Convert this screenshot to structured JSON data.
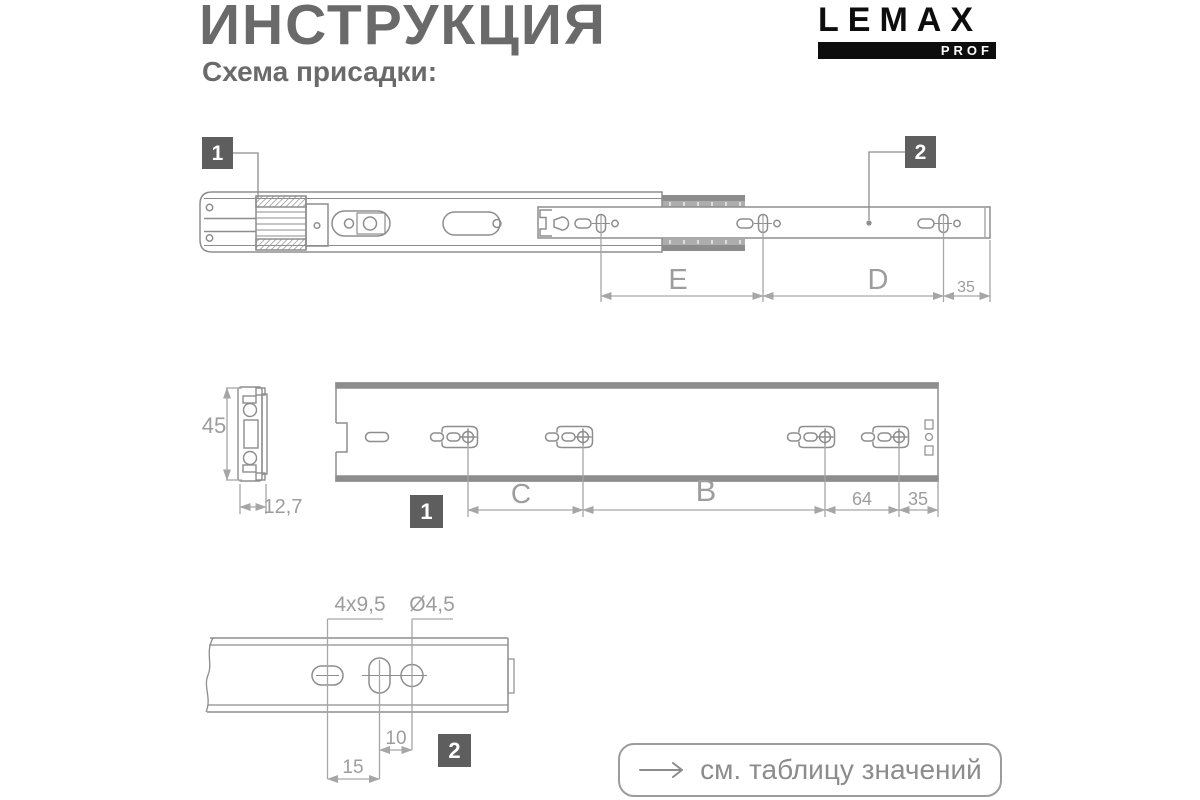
{
  "header": {
    "title": "ИНСТРУКЦИЯ",
    "subtitle": "Схема присадки:"
  },
  "logo": {
    "brand": "LEMAX",
    "badge": "PROF"
  },
  "markers": {
    "one": "1",
    "two": "2"
  },
  "dims": {
    "top": {
      "e": "E",
      "d": "D",
      "end_offset": "35"
    },
    "cross_section": {
      "height": "45",
      "width": "12,7"
    },
    "cabinet_rail": {
      "c": "C",
      "b": "B",
      "spacing": "64",
      "end_offset": "35"
    },
    "drawer_rail": {
      "slot": "4x9,5",
      "hole_dia": "Ø4,5",
      "d10": "10",
      "d15": "15"
    }
  },
  "footer": {
    "note": "см. таблицу значений"
  },
  "colors": {
    "heading_gray": "#6a6a6a",
    "line_gray": "#8d8d8d",
    "dim_gray": "#a6a6a6",
    "marker_bg": "#5e5e5e",
    "logo_black": "#0d0d0d"
  }
}
